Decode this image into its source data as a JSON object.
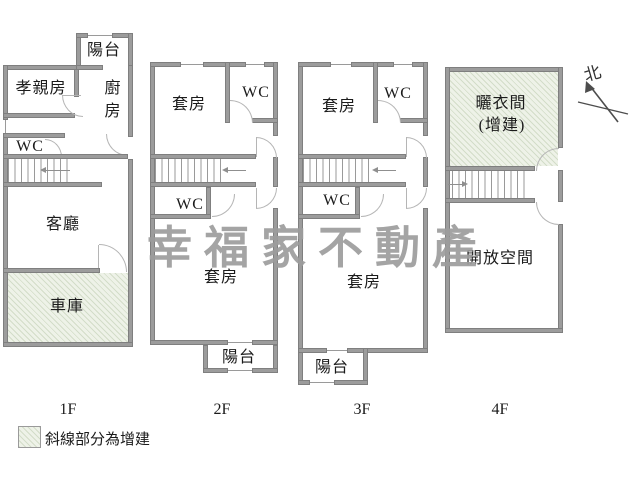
{
  "watermark": "幸福家不動產",
  "compass_label": "北",
  "legend_text": "斜線部分為增建",
  "floors": [
    {
      "label": "1F",
      "rooms": {
        "balcony": "陽台",
        "elder": "孝親房",
        "kitchen": "廚房",
        "wc": "WC",
        "living": "客廳",
        "garage": "車庫"
      }
    },
    {
      "label": "2F",
      "rooms": {
        "suite_front": "套房",
        "wc_front": "WC",
        "wc_mid": "WC",
        "suite_rear": "套房",
        "balcony": "陽台"
      }
    },
    {
      "label": "3F",
      "rooms": {
        "suite_front": "套房",
        "wc_front": "WC",
        "wc_mid": "WC",
        "suite_rear": "套房",
        "balcony": "陽台"
      }
    },
    {
      "label": "4F",
      "rooms": {
        "drying": "曬衣間",
        "drying_note": "(增建)",
        "open": "開放空間"
      }
    }
  ],
  "colors": {
    "wall": "#9c9c9c",
    "wall_edge": "#7f7f7f",
    "addition_fill": "#eef2e8",
    "watermark": "#9d9d9d",
    "text": "#1b1b1b",
    "door_arc": "#b5b5b5"
  }
}
